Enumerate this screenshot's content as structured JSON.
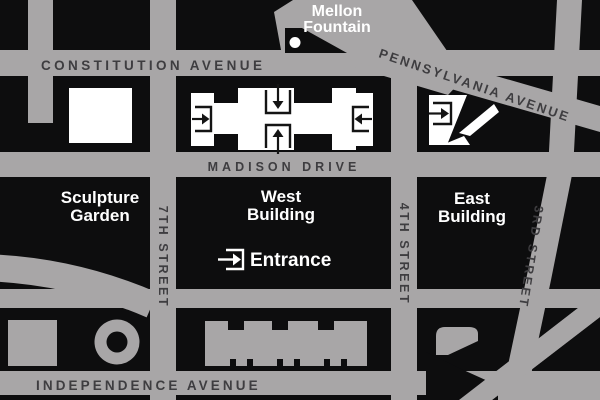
{
  "map": {
    "streets": {
      "constitution": "CONSTITUTION AVENUE",
      "madison": "MADISON DRIVE",
      "pennsylvania": "PENNSYLVANIA AVENUE",
      "independence": "INDEPENDENCE AVENUE",
      "seventh": "7TH STREET",
      "fourth": "4TH STREET",
      "third": "3RD STREET"
    },
    "places": {
      "mellon": [
        "Mellon",
        "Fountain"
      ],
      "sculpture_garden": [
        "Sculpture",
        "Garden"
      ],
      "west_building": [
        "West",
        "Building"
      ],
      "east_building": [
        "East",
        "Building"
      ],
      "entrance": "Entrance"
    },
    "icons": {
      "entrance_icon": "arrow-into-doorway-bracket",
      "fountain_dot": "white-circle-marker"
    },
    "colors": {
      "background_block": "#0d0d0e",
      "street_gray": "#a8a6a7",
      "street_text": "#3e3d40",
      "building_white": "#ffffff",
      "label_white": "#ffffff"
    }
  }
}
